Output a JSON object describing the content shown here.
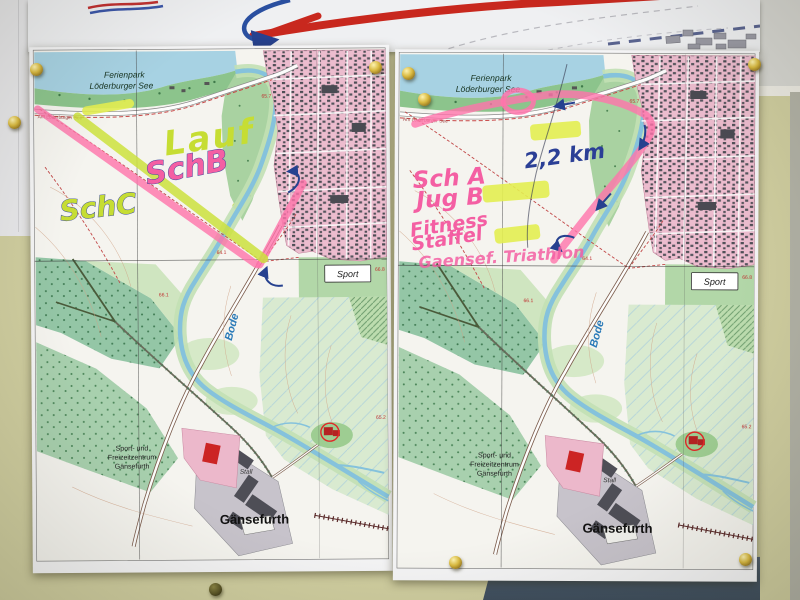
{
  "base_map": {
    "park_line1": "Ferienpark",
    "park_line2": "Löderburger See",
    "lake_road": "Am Löderburger See",
    "river": "Bode",
    "sport": "Sport",
    "village": "Gänsefurth",
    "center_line1": "Sport- und",
    "center_line2": "Freizeitzentrum",
    "center_line3": "Gänsefurth",
    "stall": "Stall",
    "spot_heights": {
      "h1": "65.7",
      "h2": "64.1",
      "h3": "66.1",
      "h4": "66.8",
      "h5": "65.2"
    }
  },
  "left_map": {
    "annotations": {
      "lauf": "Lauf",
      "sch_b": "SchB",
      "sch_c": "SchC"
    }
  },
  "right_map": {
    "annotations": {
      "sch_a": "Sch A",
      "jug_b": "Jug B",
      "fitness": "Fitness",
      "staffel": "Staffel",
      "event": "Gaensef. Triathlon",
      "distance": "2,2 km"
    }
  },
  "colors": {
    "route_pink": "#ff74ab",
    "route_yellow_green": "#cde23e",
    "highlight_yellow": "#e4ef52",
    "handwriting_pink": "#f45fa3",
    "handwriting_green": "#c6dd33",
    "ink_blue": "#2b3f96"
  }
}
